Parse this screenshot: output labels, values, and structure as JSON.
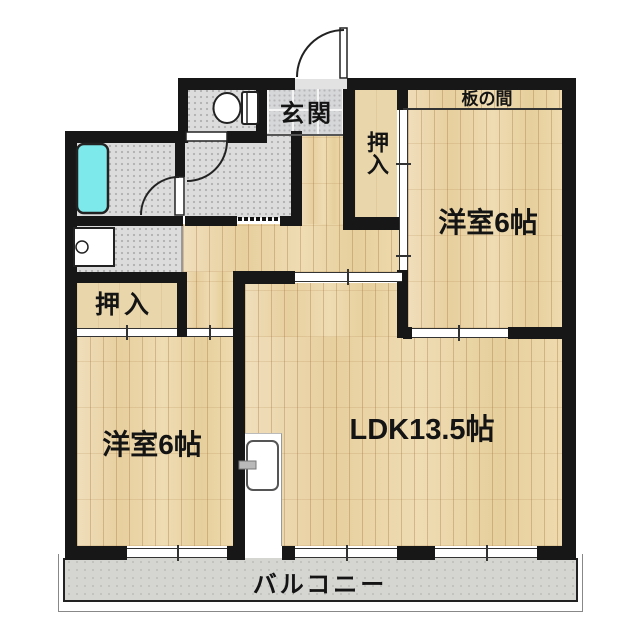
{
  "title": "2LDK apartment floor plan",
  "labels": {
    "genkan": "玄関",
    "oshiire_top": "押入",
    "oshiire_left": "押入",
    "itanoma": "板の間",
    "bedroom_right": "洋室6帖",
    "bedroom_left": "洋室6帖",
    "ldk": "LDK13.5帖",
    "balcony": "バルコニー"
  },
  "fixtures": [
    "entrance-door",
    "toilet",
    "toilet-door",
    "bathtub",
    "bath-door",
    "vanity-basin",
    "kitchen-appliance",
    "balcony-windows"
  ],
  "colors": {
    "wall": "#171717",
    "wood_floor": "#ecd7aa",
    "closet_floor": "#e9d6ab",
    "wet_area_floor": "#dcdcdc",
    "entrance_tile": "#d6d7d9",
    "bathtub": "#7de9ea",
    "balcony_floor": "#d5d6d1",
    "background": "#ffffff"
  }
}
